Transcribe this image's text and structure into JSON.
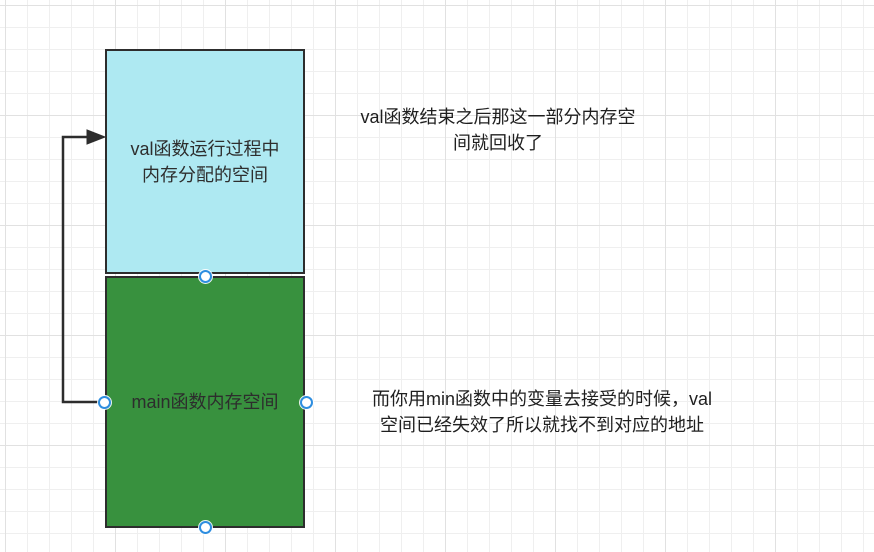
{
  "canvas": {
    "background": "#ffffff",
    "grid_minor_color": "#efefef",
    "grid_major_color": "#e1e1e1"
  },
  "shapes": {
    "val_box": {
      "label_lines": [
        "val函数运行过程中",
        "内存分配的空间"
      ],
      "fill": "#aee9f2",
      "stroke": "#2d2d2d"
    },
    "main_box": {
      "label": "main函数内存空间",
      "fill": "#38913e",
      "stroke": "#2d2d2d"
    }
  },
  "connector": {
    "stroke": "#2d2d2d",
    "from": "main-memory-box-left",
    "to": "val-memory-box-left"
  },
  "handles": {
    "fill": "#ffffff",
    "stroke": "#2e8ee0"
  },
  "annotations": {
    "recycle_note": {
      "lines": [
        "val函数结束之后那这一部分内存空",
        "间就回收了"
      ]
    },
    "invalid_note": {
      "lines": [
        "而你用min函数中的变量去接受的时候，val",
        "空间已经失效了所以就找不到对应的地址"
      ]
    }
  }
}
